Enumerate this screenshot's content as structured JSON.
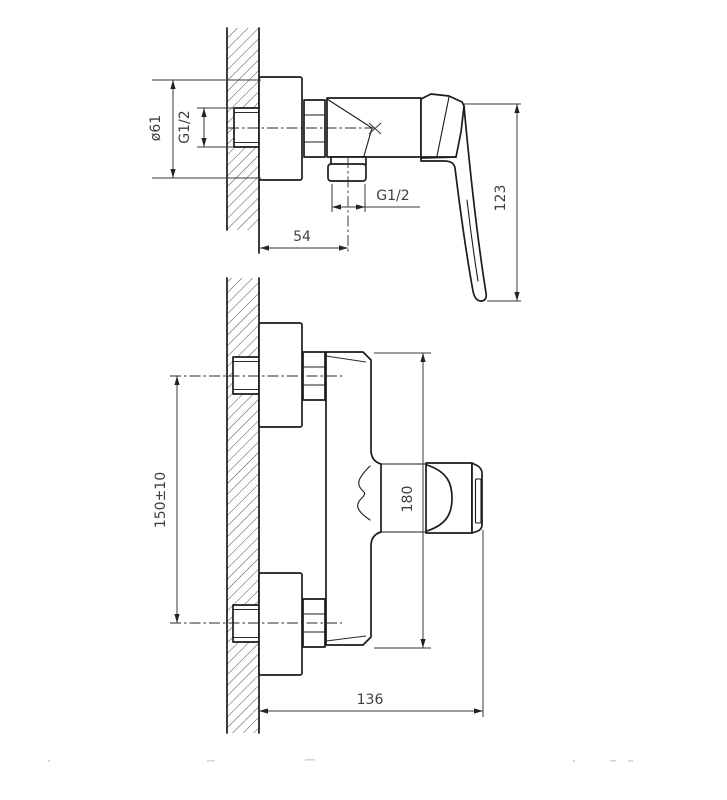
{
  "drawing": {
    "kind": "technical-installation-drawing",
    "side_view": {
      "flange_diameter": "ø61",
      "inlet_thread": "G1/2",
      "outlet_thread": "G1/2",
      "wall_to_outlet_center": "54",
      "handle_drop_height": "123"
    },
    "front_view": {
      "inlet_center_spacing": "150±10",
      "body_height": "180",
      "wall_to_handle_end": "136"
    },
    "colors": {
      "line": "#1b1b1b",
      "dimension": "#3a3a3a",
      "text": "#3f3f3f",
      "hatch": "#3a3a3a",
      "background": "#ffffff"
    }
  }
}
